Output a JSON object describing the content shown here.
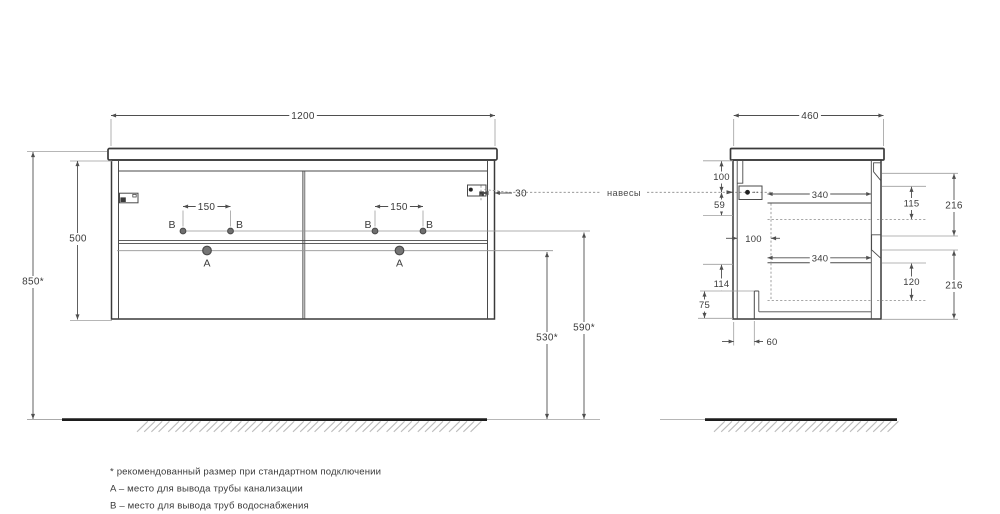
{
  "front_view": {
    "width": "1200",
    "height": "500",
    "total_height": "850*",
    "hole_spacing": "150",
    "hanger_offset": "30",
    "drain_height": "530*",
    "supply_height": "590*",
    "label_a": "A",
    "label_b": "B"
  },
  "side_view": {
    "depth": "460",
    "top_offset": "100",
    "hanger_drop": "59",
    "back_gap": "100",
    "bottom_gap": "114",
    "recess_height": "75",
    "recess_depth": "60",
    "drawer_depth": "340",
    "drawer_inner_top": "115",
    "front_panel_height": "216",
    "drawer_inner_bottom": "120"
  },
  "labels": {
    "hangers": "навесы"
  },
  "footnotes": {
    "recommended": "* рекомендованный размер при стандартном подключении",
    "a": "A – место для вывода трубы канализации",
    "b": "B – место для вывода труб водоснабжения"
  },
  "colors": {
    "line": "#3a3a3a",
    "dimension": "#4f4f4f",
    "extension": "#9e9e9e",
    "floor": "#1d1d1d",
    "hatch": "#bdbdbd",
    "hole_fill": "#707070"
  }
}
